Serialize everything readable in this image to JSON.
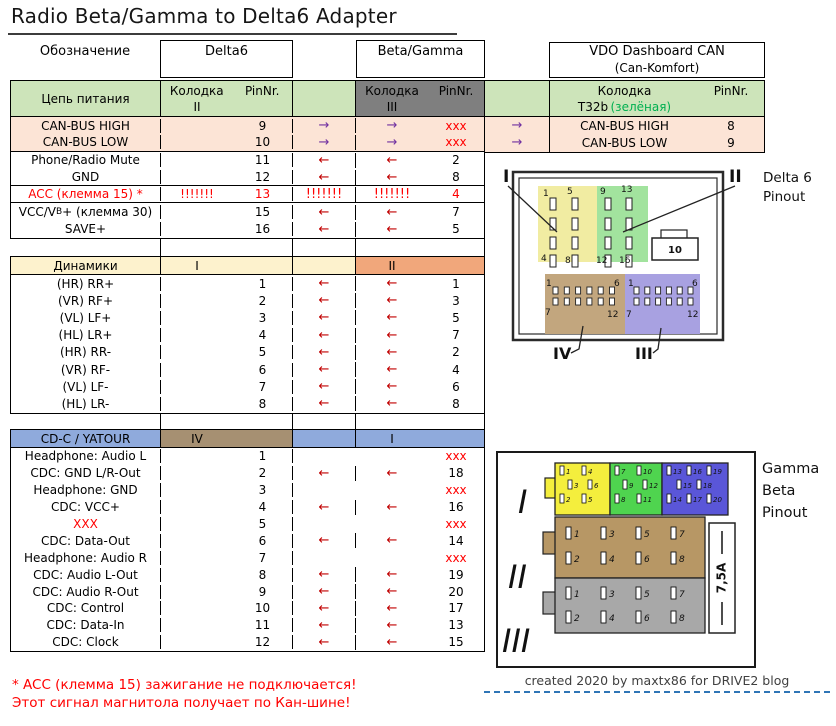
{
  "title": "Radio Beta/Gamma to Delta6 Adapter",
  "columns": {
    "designation": "Обозначение",
    "delta6": "Delta6",
    "beta_gamma": "Beta/Gamma",
    "vdo_title": "VDO Dashboard CAN",
    "vdo_subtitle": "(Can-Komfort)",
    "kolodka": "Колодка",
    "pinnr": "PinNr."
  },
  "power": {
    "label": "Цепь питания",
    "delta_block": "II",
    "bg_block": "III",
    "vdo_block": "T32b",
    "vdo_block_note": "(зелёная)",
    "rows": [
      {
        "label": "CAN-BUS HIGH",
        "d_k": "",
        "d_pin": "9",
        "mid": "→",
        "bg_k": "→",
        "bg_pin": "xxx",
        "kind": "can",
        "group_end": false
      },
      {
        "label": "CAN-BUS LOW",
        "d_k": "",
        "d_pin": "10",
        "mid": "→",
        "bg_k": "→",
        "bg_pin": "xxx",
        "kind": "can",
        "group_end": true
      },
      {
        "label": "Phone/Radio Mute",
        "d_k": "",
        "d_pin": "11",
        "mid": "←",
        "bg_k": "←",
        "bg_pin": "2",
        "kind": "norm",
        "group_end": false
      },
      {
        "label": "GND",
        "d_k": "",
        "d_pin": "12",
        "mid": "←",
        "bg_k": "←",
        "bg_pin": "8",
        "kind": "norm",
        "group_end": true
      },
      {
        "label": "ACC (клемма 15) *",
        "d_k": "!!!!!!!",
        "d_pin": "13",
        "mid": "!!!!!!!",
        "bg_k": "!!!!!!!",
        "bg_pin": "4",
        "kind": "acc",
        "group_end": true
      },
      {
        "label": "VCC/V",
        "label_sub": "B",
        "label_post": "+ (клемма 30)",
        "d_k": "",
        "d_pin": "15",
        "mid": "←",
        "bg_k": "←",
        "bg_pin": "7",
        "kind": "norm",
        "group_end": false
      },
      {
        "label": "SAVE+",
        "d_k": "",
        "d_pin": "16",
        "mid": "←",
        "bg_k": "←",
        "bg_pin": "5",
        "kind": "norm",
        "group_end": false
      }
    ],
    "vdo_rows": [
      {
        "arrow": "→",
        "label": "CAN-BUS HIGH",
        "pin": "8"
      },
      {
        "arrow": "→",
        "label": "CAN-BUS LOW",
        "pin": "9"
      }
    ]
  },
  "speakers": {
    "label": "Динамики",
    "delta_block": "I",
    "bg_block": "II",
    "rows": [
      {
        "label": "(HR) RR+",
        "d_pin": "1",
        "mid": "←",
        "bg_k": "←",
        "bg_pin": "1",
        "kind": "norm"
      },
      {
        "label": "(VR) RF+",
        "d_pin": "2",
        "mid": "←",
        "bg_k": "←",
        "bg_pin": "3",
        "kind": "norm"
      },
      {
        "label": "(VL) LF+",
        "d_pin": "3",
        "mid": "←",
        "bg_k": "←",
        "bg_pin": "5",
        "kind": "norm"
      },
      {
        "label": "(HL) LR+",
        "d_pin": "4",
        "mid": "←",
        "bg_k": "←",
        "bg_pin": "7",
        "kind": "norm"
      },
      {
        "label": "(HR) RR-",
        "d_pin": "5",
        "mid": "←",
        "bg_k": "←",
        "bg_pin": "2",
        "kind": "norm"
      },
      {
        "label": "(VR) RF-",
        "d_pin": "6",
        "mid": "←",
        "bg_k": "←",
        "bg_pin": "4",
        "kind": "norm"
      },
      {
        "label": "(VL) LF-",
        "d_pin": "7",
        "mid": "←",
        "bg_k": "←",
        "bg_pin": "6",
        "kind": "norm"
      },
      {
        "label": "(HL) LR-",
        "d_pin": "8",
        "mid": "←",
        "bg_k": "←",
        "bg_pin": "8",
        "kind": "norm"
      }
    ]
  },
  "cdc": {
    "label": "CD-C / YATOUR",
    "delta_block": "IV",
    "bg_block": "I",
    "rows": [
      {
        "label": "Headphone: Audio L",
        "d_pin": "1",
        "mid": "",
        "bg_k": "",
        "bg_pin": "xxx",
        "kind": "norm"
      },
      {
        "label": "CDC: GND L/R-Out",
        "d_pin": "2",
        "mid": "←",
        "bg_k": "←",
        "bg_pin": "18",
        "kind": "norm"
      },
      {
        "label": "Headphone: GND",
        "d_pin": "3",
        "mid": "",
        "bg_k": "",
        "bg_pin": "xxx",
        "kind": "norm"
      },
      {
        "label": "CDC: VCC+",
        "d_pin": "4",
        "mid": "←",
        "bg_k": "←",
        "bg_pin": "16",
        "kind": "norm"
      },
      {
        "label": "XXX",
        "d_pin": "5",
        "mid": "",
        "bg_k": "",
        "bg_pin": "xxx",
        "kind": "redlabel"
      },
      {
        "label": "CDC: Data-Out",
        "d_pin": "6",
        "mid": "←",
        "bg_k": "←",
        "bg_pin": "14",
        "kind": "norm"
      },
      {
        "label": "Headphone: Audio R",
        "d_pin": "7",
        "mid": "",
        "bg_k": "",
        "bg_pin": "xxx",
        "kind": "norm"
      },
      {
        "label": "CDC: Audio L-Out",
        "d_pin": "8",
        "mid": "←",
        "bg_k": "←",
        "bg_pin": "19",
        "kind": "norm"
      },
      {
        "label": "CDC: Audio R-Out",
        "d_pin": "9",
        "mid": "←",
        "bg_k": "←",
        "bg_pin": "20",
        "kind": "norm"
      },
      {
        "label": "CDC: Control",
        "d_pin": "10",
        "mid": "←",
        "bg_k": "←",
        "bg_pin": "17",
        "kind": "norm"
      },
      {
        "label": "CDC: Data-In",
        "d_pin": "11",
        "mid": "←",
        "bg_k": "←",
        "bg_pin": "13",
        "kind": "norm"
      },
      {
        "label": "CDC: Clock",
        "d_pin": "12",
        "mid": "←",
        "bg_k": "←",
        "bg_pin": "15",
        "kind": "norm"
      }
    ]
  },
  "footnote": {
    "line1": "* ACC (клемма 15) зажигание не подключается!",
    "line2": "Этот сигнал магнитола получает по Кан-шине!"
  },
  "credit": "created 2020 by maxtx86 for DRIVE2 blog",
  "delta6_pinout": {
    "caption1": "Delta 6",
    "caption2": "Pinout",
    "label_top_left": "I",
    "label_top_right": "II",
    "label_bottom_left": "IV",
    "label_bottom_right": "III",
    "yellow_corners": [
      "1",
      "5",
      "4",
      "8"
    ],
    "green_corners": [
      "9",
      "13",
      "12",
      "16"
    ],
    "center_label": "10",
    "tan_corners": [
      "1",
      "6",
      "7",
      "12"
    ],
    "purple_corners": [
      "1",
      "6",
      "7",
      "12"
    ]
  },
  "gamma_pinout": {
    "caption1": "Gamma",
    "caption2": "Beta",
    "caption3": "Pinout",
    "roman": [
      "I",
      "II",
      "III"
    ],
    "fuse": "7,5A",
    "block1_yellow": [
      [
        "1",
        "4"
      ],
      [
        "3",
        "6"
      ],
      [
        "2",
        "5"
      ]
    ],
    "block1_green": [
      [
        "7",
        "10"
      ],
      [
        "9",
        "12"
      ],
      [
        "8",
        "11"
      ]
    ],
    "block1_blue": [
      [
        "13",
        "16",
        "19"
      ],
      [
        "15",
        "18"
      ],
      [
        "14",
        "17",
        "20"
      ]
    ],
    "block2_pins": [
      [
        "1",
        "3",
        "5",
        "7"
      ],
      [
        "2",
        "4",
        "6",
        "8"
      ]
    ],
    "block3_pins": [
      [
        "1",
        "3",
        "5",
        "7"
      ],
      [
        "2",
        "4",
        "6",
        "8"
      ]
    ]
  },
  "colors": {
    "section_green": "#cde4ba",
    "cell_gray": "#7f7f7f",
    "row_peach": "#fce4d6",
    "section_cream": "#fdf2cd",
    "cell_orange": "#f1a77b",
    "section_blue": "#8faadc",
    "cell_tan": "#a69072",
    "arrow_left": "#c00000",
    "arrow_right": "#7030a0",
    "alert_red": "#ff0000",
    "note_green": "#00b050",
    "credit_line_blue": "#2e75b6",
    "d6_yellow": "#f1eca2",
    "d6_green": "#a2e39e",
    "d6_tan": "#c2a67e",
    "d6_purple": "#a8a1e1",
    "g_yellow": "#f4ee3d",
    "g_green": "#4fd44f",
    "g_blue": "#5a56d8",
    "g_tan": "#b79765",
    "g_gray": "#a8a8a8"
  }
}
